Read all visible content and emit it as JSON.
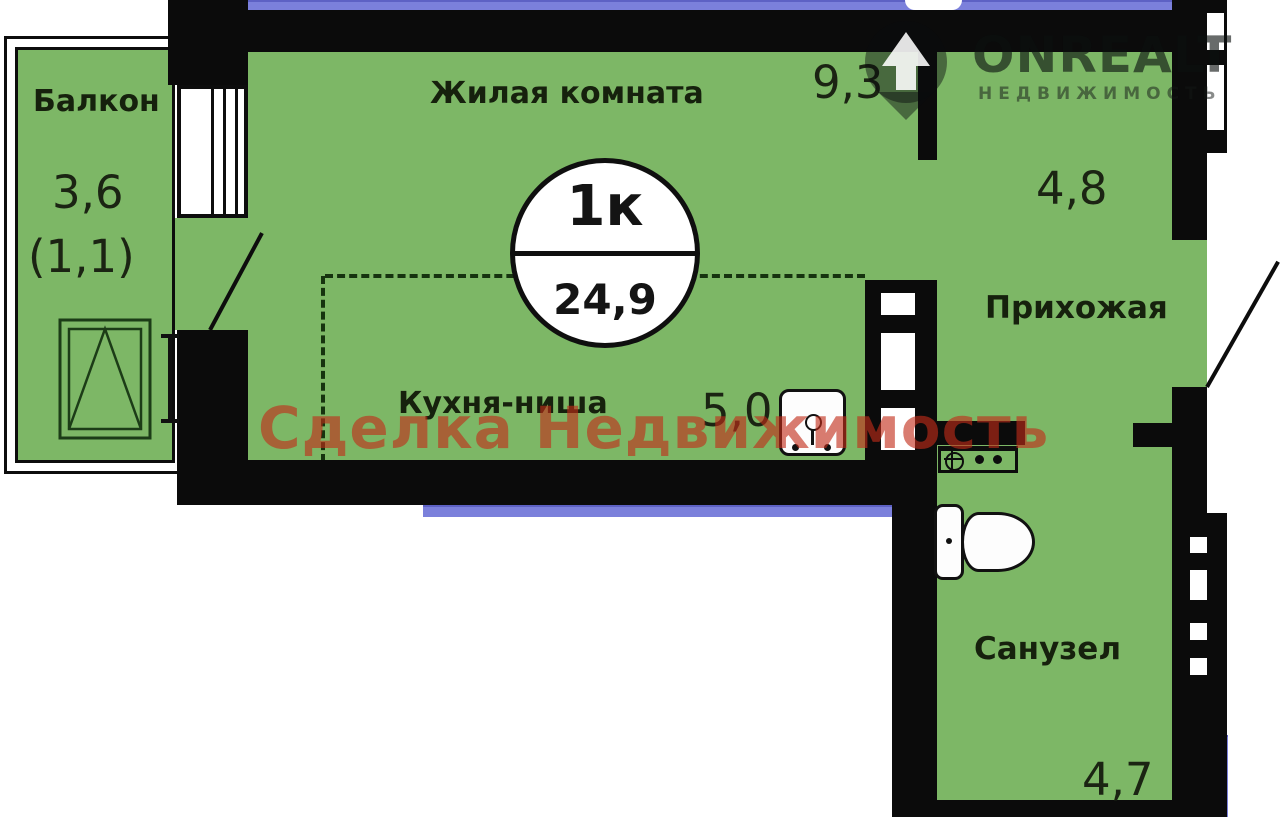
{
  "title": "Планировка квартиры 1к",
  "badge": {
    "type": "1к",
    "total_area": "24,9"
  },
  "rooms": {
    "balcony": {
      "label": "Балкон",
      "area": "3,6",
      "area_reduced": "(1,1)"
    },
    "living": {
      "label": "Жилая комната",
      "area": "9,3"
    },
    "kitchen": {
      "label": "Кухня-ниша",
      "area": "5,0"
    },
    "hallway": {
      "label": "Прихожая",
      "area": "4,8"
    },
    "bathroom": {
      "label": "Санузел",
      "area": "4,7"
    }
  },
  "watermark": "Сделка Недвижимость",
  "logo": {
    "brand": "ONREALT",
    "subtitle": "НЕДВИЖИМОСТЬ"
  },
  "icons": [
    "location-pin-icon",
    "window-icon",
    "door-leaf-icon",
    "toilet-icon",
    "sink-icon",
    "appliance-icon",
    "vent-shaft"
  ],
  "colors": {
    "floor_green": "#7db766",
    "wall_black": "#0b0b0b",
    "accent_purple": "#7b80db",
    "watermark_red": "rgba(193,44,25,0.62)",
    "line_dark_green": "#16330f"
  }
}
